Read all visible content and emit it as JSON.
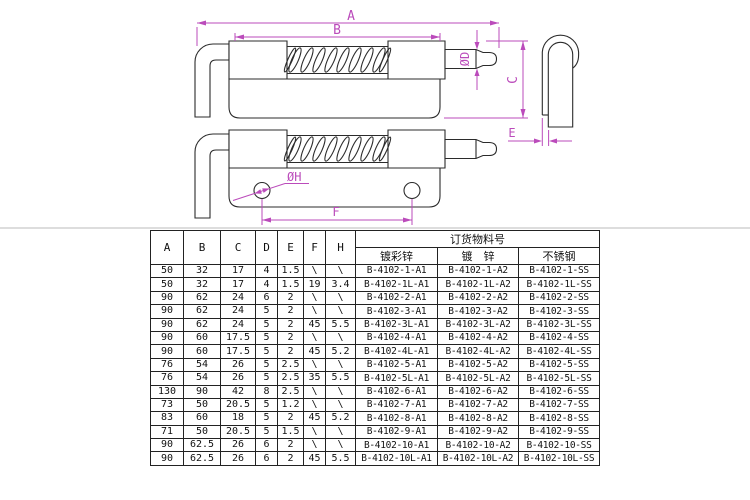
{
  "page": {
    "background": "#ffffff"
  },
  "drawing": {
    "line_color": "#2b2b2b",
    "dimension_color": "#bb4bbb",
    "labels": {
      "overall_length": "A",
      "body_length": "B",
      "height": "C",
      "pin_diameter": "ØD",
      "plate_thickness": "E",
      "hole_spacing": "F",
      "hole_diameter": "ØH"
    }
  },
  "table": {
    "dim_headers": [
      "A",
      "B",
      "C",
      "D",
      "E",
      "F",
      "H"
    ],
    "order_header": "订货物料号",
    "finish_headers": [
      "镀彩锌",
      "镀　锌",
      "不锈钢"
    ],
    "rows": [
      [
        "50",
        "32",
        "17",
        "4",
        "1.5",
        "\\",
        "\\",
        "B-4102-1-A1",
        "B-4102-1-A2",
        "B-4102-1-SS"
      ],
      [
        "50",
        "32",
        "17",
        "4",
        "1.5",
        "19",
        "3.4",
        "B-4102-1L-A1",
        "B-4102-1L-A2",
        "B-4102-1L-SS"
      ],
      [
        "90",
        "62",
        "24",
        "6",
        "2",
        "\\",
        "\\",
        "B-4102-2-A1",
        "B-4102-2-A2",
        "B-4102-2-SS"
      ],
      [
        "90",
        "62",
        "24",
        "5",
        "2",
        "\\",
        "\\",
        "B-4102-3-A1",
        "B-4102-3-A2",
        "B-4102-3-SS"
      ],
      [
        "90",
        "62",
        "24",
        "5",
        "2",
        "45",
        "5.5",
        "B-4102-3L-A1",
        "B-4102-3L-A2",
        "B-4102-3L-SS"
      ],
      [
        "90",
        "60",
        "17.5",
        "5",
        "2",
        "\\",
        "\\",
        "B-4102-4-A1",
        "B-4102-4-A2",
        "B-4102-4-SS"
      ],
      [
        "90",
        "60",
        "17.5",
        "5",
        "2",
        "45",
        "5.2",
        "B-4102-4L-A1",
        "B-4102-4L-A2",
        "B-4102-4L-SS"
      ],
      [
        "76",
        "54",
        "26",
        "5",
        "2.5",
        "\\",
        "\\",
        "B-4102-5-A1",
        "B-4102-5-A2",
        "B-4102-5-SS"
      ],
      [
        "76",
        "54",
        "26",
        "5",
        "2.5",
        "35",
        "5.5",
        "B-4102-5L-A1",
        "B-4102-5L-A2",
        "B-4102-5L-SS"
      ],
      [
        "130",
        "90",
        "42",
        "8",
        "2.5",
        "\\",
        "\\",
        "B-4102-6-A1",
        "B-4102-6-A2",
        "B-4102-6-SS"
      ],
      [
        "73",
        "50",
        "20.5",
        "5",
        "1.2",
        "\\",
        "\\",
        "B-4102-7-A1",
        "B-4102-7-A2",
        "B-4102-7-SS"
      ],
      [
        "83",
        "60",
        "18",
        "5",
        "2",
        "45",
        "5.2",
        "B-4102-8-A1",
        "B-4102-8-A2",
        "B-4102-8-SS"
      ],
      [
        "71",
        "50",
        "20.5",
        "5",
        "1.5",
        "\\",
        "\\",
        "B-4102-9-A1",
        "B-4102-9-A2",
        "B-4102-9-SS"
      ],
      [
        "90",
        "62.5",
        "26",
        "6",
        "2",
        "\\",
        "\\",
        "B-4102-10-A1",
        "B-4102-10-A2",
        "B-4102-10-SS"
      ],
      [
        "90",
        "62.5",
        "26",
        "6",
        "2",
        "45",
        "5.5",
        "B-4102-10L-A1",
        "B-4102-10L-A2",
        "B-4102-10L-SS"
      ]
    ]
  }
}
